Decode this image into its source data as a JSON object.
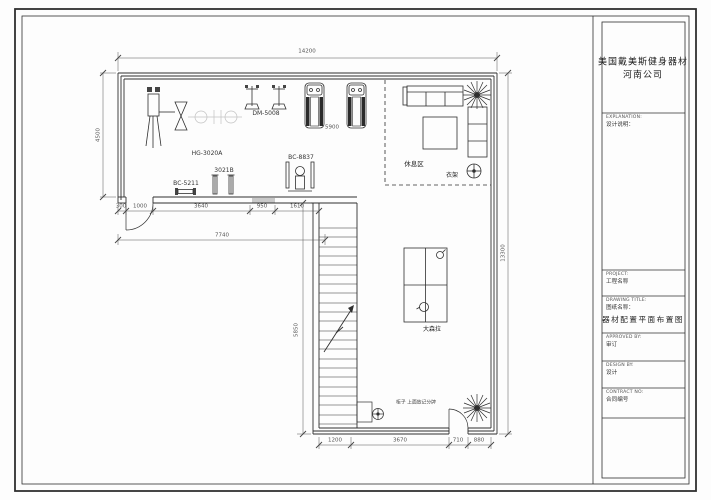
{
  "titleblock": {
    "company_line1": "美国戴美斯健身器材",
    "company_line2": "河南公司",
    "explanation_en": "EXPLANATION:",
    "explanation_cn": "设计说明：",
    "project_en": "PROJECT:",
    "project_cn": "工程名称",
    "drawing_en": "DRAWING TITLE:",
    "drawing_cn": "图纸名称：",
    "drawing_main": "器材配置平面布置图",
    "approved_en": "APPROVED BY:",
    "approved_cn": "审订",
    "design_en": "DESIGN BY:",
    "design_cn": "设计",
    "contract_en": "CONTRACT NO:",
    "contract_cn": "合同编号"
  },
  "dims": {
    "top": "14200",
    "left": "4500",
    "right": "13300",
    "stairs": "5850",
    "treadmill": "5900",
    "interior": [
      "300",
      "1000",
      "3640",
      "950",
      "1610"
    ],
    "interior_total": "7740",
    "bottom": [
      "1200",
      "3670",
      "710",
      "880"
    ]
  },
  "equipment": {
    "hg": "HG-3020A",
    "dm": "DM-5008",
    "bc8837": "BC-8837",
    "bc5211": "BC-5211",
    "b3021": "3021B"
  },
  "rooms": {
    "rest": "休息区",
    "coat": "衣架",
    "puller": "大森拉",
    "scoreboard": "柜子 上面放记分牌"
  }
}
